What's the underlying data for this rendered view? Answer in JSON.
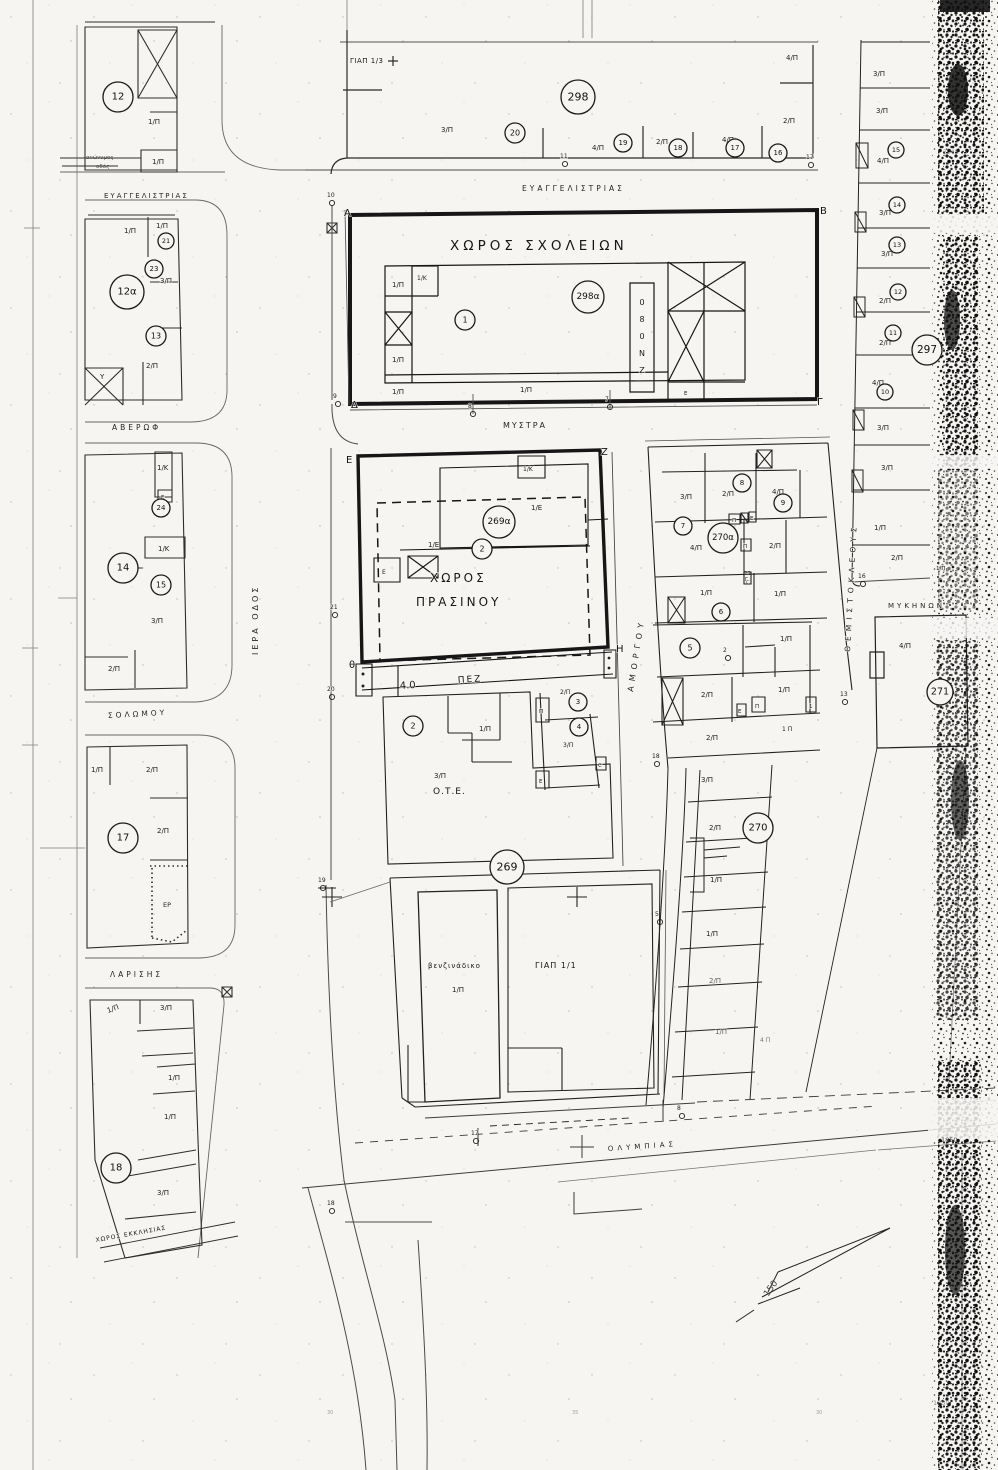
{
  "map": {
    "street_labels": [
      {
        "t": "ΕΥΑΓΓΕΛΙΣΤΡΙΑΣ",
        "x": 104,
        "y": 198,
        "s": 7,
        "ls": 2
      },
      {
        "t": "ΕΥΑΓΓΕΛΙΣΤΡΙΑΣ",
        "x": 522,
        "y": 191,
        "s": 7.5,
        "ls": 3
      },
      {
        "t": "ΑΒΕΡΩΦ",
        "x": 112,
        "y": 430,
        "s": 7.5,
        "ls": 3
      },
      {
        "t": "ΜΥΣΤΡΑ",
        "x": 503,
        "y": 428,
        "s": 8,
        "ls": 2
      },
      {
        "t": "ΣΟΛΩΜΟΥ",
        "x": 108,
        "y": 718,
        "s": 7.5,
        "ls": 3,
        "r": -3
      },
      {
        "t": "ΛΑΡΙΣΗΣ",
        "x": 110,
        "y": 977,
        "s": 7.5,
        "ls": 3
      },
      {
        "t": "ΙΕΡΑ ΟΔΟΣ",
        "x": 258,
        "y": 655,
        "s": 8,
        "ls": 3,
        "r": -90
      },
      {
        "t": "ΑΜΟΡΓΟΥ",
        "x": 633,
        "y": 692,
        "s": 8,
        "ls": 5,
        "r": -81
      },
      {
        "t": "ΘΕΜΙΣΤΟΚΛΕΟΥΣ",
        "x": 850,
        "y": 652,
        "s": 7.5,
        "ls": 5,
        "r": -87
      },
      {
        "t": "ΜΥΚΗΝΩΝ",
        "x": 888,
        "y": 608,
        "s": 7,
        "ls": 3
      },
      {
        "t": "ΟΛΥΜΠΙΑΣ",
        "x": 608,
        "y": 1151,
        "s": 7,
        "ls": 4,
        "r": -4
      }
    ],
    "area_labels": [
      {
        "t": "ΧΩΡΟΣ  ΣΧΟΛΕΙΩΝ",
        "x": 450,
        "y": 250,
        "s": 13.5,
        "ls": 4
      },
      {
        "t": "ΧΩΡΟΣ",
        "x": 430,
        "y": 582,
        "s": 12,
        "ls": 3
      },
      {
        "t": "ΠΡΑΣΙΝΟΥ",
        "x": 416,
        "y": 606,
        "s": 12,
        "ls": 3
      },
      {
        "t": "ΠΕΖ",
        "x": 458,
        "y": 683,
        "s": 9,
        "ls": 2,
        "r": -4
      },
      {
        "t": "Ο.Τ.Ε.",
        "x": 433,
        "y": 794,
        "s": 9,
        "ls": 1
      },
      {
        "t": "βενζινάδικο",
        "x": 428,
        "y": 968,
        "s": 7,
        "ls": 1
      },
      {
        "t": "ΓΙΑΠ 1/1",
        "x": 535,
        "y": 968,
        "s": 8,
        "ls": 1
      },
      {
        "t": "ΓΙΑΠ 1/3",
        "x": 350,
        "y": 63,
        "s": 7,
        "ls": 0.5
      },
      {
        "t": "ΧΩΡΟΣ ΕΚΚΛΗΣΙΑΣ",
        "x": 96,
        "y": 1242,
        "s": 6,
        "ls": 1,
        "r": -10
      }
    ],
    "circled": [
      {
        "n": "12",
        "x": 118,
        "y": 97,
        "r": 15,
        "fs": 10
      },
      {
        "n": "298",
        "x": 578,
        "y": 97,
        "r": 17,
        "fs": 11
      },
      {
        "n": "20",
        "x": 515,
        "y": 133,
        "r": 10,
        "fs": 8
      },
      {
        "n": "19",
        "x": 623,
        "y": 143,
        "r": 9,
        "fs": 7
      },
      {
        "n": "18",
        "x": 678,
        "y": 148,
        "r": 9,
        "fs": 7
      },
      {
        "n": "17",
        "x": 735,
        "y": 148,
        "r": 9,
        "fs": 7
      },
      {
        "n": "16",
        "x": 778,
        "y": 153,
        "r": 9,
        "fs": 7
      },
      {
        "n": "12α",
        "x": 127,
        "y": 292,
        "r": 17,
        "fs": 10
      },
      {
        "n": "21",
        "x": 166,
        "y": 241,
        "r": 8,
        "fs": 6.5
      },
      {
        "n": "23",
        "x": 154,
        "y": 269,
        "r": 9,
        "fs": 7
      },
      {
        "n": "13",
        "x": 156,
        "y": 336,
        "r": 10,
        "fs": 8
      },
      {
        "n": "24",
        "x": 161,
        "y": 508,
        "r": 9,
        "fs": 7
      },
      {
        "n": "14",
        "x": 123,
        "y": 568,
        "r": 15,
        "fs": 10
      },
      {
        "n": "15",
        "x": 161,
        "y": 585,
        "r": 10,
        "fs": 8
      },
      {
        "n": "17",
        "x": 123,
        "y": 838,
        "r": 15,
        "fs": 10
      },
      {
        "n": "18",
        "x": 116,
        "y": 1168,
        "r": 15,
        "fs": 10
      },
      {
        "n": "298α",
        "x": 588,
        "y": 297,
        "r": 16,
        "fs": 9
      },
      {
        "n": "1",
        "x": 465,
        "y": 320,
        "r": 10,
        "fs": 8
      },
      {
        "n": "269α",
        "x": 499,
        "y": 522,
        "r": 16,
        "fs": 9
      },
      {
        "n": "2",
        "x": 482,
        "y": 549,
        "r": 10,
        "fs": 8
      },
      {
        "n": "2",
        "x": 413,
        "y": 726,
        "r": 10,
        "fs": 8
      },
      {
        "n": "269",
        "x": 507,
        "y": 867,
        "r": 17,
        "fs": 11
      },
      {
        "n": "3",
        "x": 578,
        "y": 702,
        "r": 9,
        "fs": 7
      },
      {
        "n": "4",
        "x": 579,
        "y": 727,
        "r": 9,
        "fs": 7
      },
      {
        "n": "7",
        "x": 683,
        "y": 526,
        "r": 9,
        "fs": 7
      },
      {
        "n": "8",
        "x": 742,
        "y": 483,
        "r": 9,
        "fs": 7
      },
      {
        "n": "9",
        "x": 783,
        "y": 503,
        "r": 9,
        "fs": 7
      },
      {
        "n": "270α",
        "x": 723,
        "y": 538,
        "r": 15,
        "fs": 8.5
      },
      {
        "n": "6",
        "x": 721,
        "y": 612,
        "r": 9,
        "fs": 7
      },
      {
        "n": "5",
        "x": 690,
        "y": 648,
        "r": 10,
        "fs": 8
      },
      {
        "n": "270",
        "x": 758,
        "y": 828,
        "r": 15,
        "fs": 10
      },
      {
        "n": "271",
        "x": 940,
        "y": 692,
        "r": 13,
        "fs": 9.5
      },
      {
        "n": "297",
        "x": 927,
        "y": 350,
        "r": 15,
        "fs": 10.5
      },
      {
        "n": "15",
        "x": 896,
        "y": 150,
        "r": 8,
        "fs": 6.5
      },
      {
        "n": "14",
        "x": 897,
        "y": 205,
        "r": 8,
        "fs": 6.5
      },
      {
        "n": "13",
        "x": 897,
        "y": 245,
        "r": 8,
        "fs": 6.5
      },
      {
        "n": "12",
        "x": 898,
        "y": 292,
        "r": 8,
        "fs": 6.5
      },
      {
        "n": "11",
        "x": 893,
        "y": 333,
        "r": 8,
        "fs": 6.5
      },
      {
        "n": "10",
        "x": 885,
        "y": 392,
        "r": 8,
        "fs": 6.5
      }
    ],
    "small_labels": [
      {
        "t": "1/Π",
        "x": 148,
        "y": 124
      },
      {
        "t": "1/Π",
        "x": 152,
        "y": 164
      },
      {
        "t": "1/Π",
        "x": 124,
        "y": 233
      },
      {
        "t": "1/Π",
        "x": 156,
        "y": 228
      },
      {
        "t": "3/Π",
        "x": 160,
        "y": 283
      },
      {
        "t": "2/Π",
        "x": 146,
        "y": 368
      },
      {
        "t": "Υ",
        "x": 100,
        "y": 379
      },
      {
        "t": "1/Κ",
        "x": 157,
        "y": 470
      },
      {
        "t": "Ε",
        "x": 161,
        "y": 499,
        "s": 5.5
      },
      {
        "t": "1/Κ",
        "x": 158,
        "y": 551
      },
      {
        "t": "3/Π",
        "x": 151,
        "y": 623
      },
      {
        "t": "2/Π",
        "x": 108,
        "y": 671
      },
      {
        "t": "1/Π",
        "x": 91,
        "y": 772
      },
      {
        "t": "2/Π",
        "x": 146,
        "y": 772
      },
      {
        "t": "2/Π",
        "x": 157,
        "y": 833
      },
      {
        "t": "ΕΡ",
        "x": 163,
        "y": 907,
        "s": 6.5
      },
      {
        "t": "1/Π",
        "x": 108,
        "y": 1013,
        "r": -20
      },
      {
        "t": "3/Π",
        "x": 160,
        "y": 1010
      },
      {
        "t": "1/Π",
        "x": 168,
        "y": 1080
      },
      {
        "t": "1/Π",
        "x": 164,
        "y": 1119
      },
      {
        "t": "3/Π",
        "x": 157,
        "y": 1195
      },
      {
        "t": "3/Π",
        "x": 441,
        "y": 132
      },
      {
        "t": "4/Π",
        "x": 592,
        "y": 150
      },
      {
        "t": "2/Π",
        "x": 656,
        "y": 144
      },
      {
        "t": "4/Π",
        "x": 722,
        "y": 142
      },
      {
        "t": "2/Π",
        "x": 783,
        "y": 123
      },
      {
        "t": "4/Π",
        "x": 786,
        "y": 60
      },
      {
        "t": "1/Π",
        "x": 392,
        "y": 287
      },
      {
        "t": "1/Κ",
        "x": 417,
        "y": 280,
        "s": 6
      },
      {
        "t": "1/Π",
        "x": 392,
        "y": 362
      },
      {
        "t": "1/Π",
        "x": 392,
        "y": 394
      },
      {
        "t": "1/Π",
        "x": 520,
        "y": 392
      },
      {
        "t": "Ε",
        "x": 684,
        "y": 395,
        "s": 5.5
      },
      {
        "t": "1/Κ",
        "x": 523,
        "y": 471,
        "s": 6
      },
      {
        "t": "1/Ε",
        "x": 531,
        "y": 510
      },
      {
        "t": "1/Ε",
        "x": 428,
        "y": 547
      },
      {
        "t": "Ε",
        "x": 382,
        "y": 574,
        "s": 6
      },
      {
        "t": "4.0",
        "x": 400,
        "y": 689,
        "s": 10,
        "r": -4
      },
      {
        "t": "1/Π",
        "x": 479,
        "y": 731
      },
      {
        "t": "3/Π",
        "x": 434,
        "y": 778
      },
      {
        "t": "2/Π",
        "x": 560,
        "y": 694,
        "s": 6
      },
      {
        "t": "Π",
        "x": 539,
        "y": 713,
        "s": 5.5
      },
      {
        "t": "3/Π",
        "x": 563,
        "y": 747,
        "s": 6
      },
      {
        "t": "Ε",
        "x": 539,
        "y": 783,
        "s": 5.5
      },
      {
        "t": "C",
        "x": 598,
        "y": 767,
        "s": 5.5
      },
      {
        "t": "3/Π",
        "x": 680,
        "y": 499
      },
      {
        "t": "2/Π",
        "x": 722,
        "y": 496
      },
      {
        "t": "4/Π",
        "x": 772,
        "y": 494
      },
      {
        "t": "4/Π",
        "x": 690,
        "y": 550
      },
      {
        "t": "2/Π",
        "x": 769,
        "y": 548
      },
      {
        "t": "Π",
        "x": 732,
        "y": 522,
        "s": 5.5
      },
      {
        "t": "Ε",
        "x": 750,
        "y": 520,
        "s": 5.5
      },
      {
        "t": "Π",
        "x": 743,
        "y": 548,
        "s": 5.5
      },
      {
        "t": "1/Π",
        "x": 700,
        "y": 595
      },
      {
        "t": "1/Π",
        "x": 774,
        "y": 596
      },
      {
        "t": "Γ",
        "x": 745,
        "y": 581,
        "s": 5
      },
      {
        "t": "1/Π",
        "x": 780,
        "y": 641
      },
      {
        "t": "2/Π",
        "x": 701,
        "y": 697
      },
      {
        "t": "1/Π",
        "x": 778,
        "y": 692
      },
      {
        "t": "Ε",
        "x": 738,
        "y": 713,
        "s": 5.5
      },
      {
        "t": "Π",
        "x": 755,
        "y": 708,
        "s": 5.5
      },
      {
        "t": "1",
        "x": 809,
        "y": 708,
        "s": 5.5
      },
      {
        "t": "2/Π",
        "x": 706,
        "y": 740
      },
      {
        "t": "1 Π",
        "x": 782,
        "y": 731,
        "s": 6
      },
      {
        "t": "3/Π",
        "x": 701,
        "y": 782
      },
      {
        "t": "3/Π",
        "x": 703,
        "y": 786,
        "o": 0
      },
      {
        "t": "2/Π",
        "x": 709,
        "y": 830
      },
      {
        "t": "1/Π",
        "x": 710,
        "y": 882
      },
      {
        "t": "1/Π",
        "x": 706,
        "y": 936
      },
      {
        "t": "2/Π",
        "x": 709,
        "y": 983,
        "o": 0.7
      },
      {
        "t": "1/Π",
        "x": 715,
        "y": 1034,
        "o": 0.7
      },
      {
        "t": "4 Π",
        "x": 760,
        "y": 1042,
        "o": 0.6,
        "s": 6
      },
      {
        "t": "3/Π",
        "x": 873,
        "y": 76
      },
      {
        "t": "3/Π",
        "x": 876,
        "y": 113
      },
      {
        "t": "4/Π",
        "x": 877,
        "y": 163
      },
      {
        "t": "3/Π",
        "x": 879,
        "y": 215
      },
      {
        "t": "3/Π",
        "x": 881,
        "y": 256
      },
      {
        "t": "2/Π",
        "x": 879,
        "y": 303
      },
      {
        "t": "2/Π",
        "x": 879,
        "y": 345
      },
      {
        "t": "4/Π",
        "x": 872,
        "y": 385
      },
      {
        "t": "3/Π",
        "x": 877,
        "y": 430
      },
      {
        "t": "3/Π",
        "x": 881,
        "y": 470
      },
      {
        "t": "1/Π",
        "x": 874,
        "y": 530
      },
      {
        "t": "2/Π",
        "x": 891,
        "y": 560
      },
      {
        "t": "1/Π",
        "x": 936,
        "y": 570,
        "s": 5.5
      },
      {
        "t": "4/Π",
        "x": 899,
        "y": 648
      },
      {
        "t": "1/Π",
        "x": 452,
        "y": 992
      }
    ],
    "points": [
      {
        "t": "10",
        "x": 327,
        "y": 197
      },
      {
        "t": "11",
        "x": 560,
        "y": 158
      },
      {
        "t": "17",
        "x": 806,
        "y": 159
      },
      {
        "t": "9",
        "x": 333,
        "y": 398
      },
      {
        "t": "8",
        "x": 468,
        "y": 408
      },
      {
        "t": "7",
        "x": 605,
        "y": 401
      },
      {
        "t": "21",
        "x": 330,
        "y": 609
      },
      {
        "t": "20",
        "x": 327,
        "y": 691
      },
      {
        "t": "19",
        "x": 318,
        "y": 882
      },
      {
        "t": "18",
        "x": 327,
        "y": 1205
      },
      {
        "t": "17",
        "x": 471,
        "y": 1135
      },
      {
        "t": "8",
        "x": 677,
        "y": 1110
      },
      {
        "t": "16",
        "x": 858,
        "y": 578
      },
      {
        "t": "13",
        "x": 840,
        "y": 696
      },
      {
        "t": "5",
        "x": 655,
        "y": 916
      },
      {
        "t": "2",
        "x": 723,
        "y": 652
      },
      {
        "t": "18",
        "x": 652,
        "y": 758
      }
    ],
    "corners": [
      {
        "t": "Α",
        "x": 344,
        "y": 216
      },
      {
        "t": "Β",
        "x": 820,
        "y": 214
      },
      {
        "t": "Δ",
        "x": 351,
        "y": 408
      },
      {
        "t": "Γ",
        "x": 817,
        "y": 405
      },
      {
        "t": "Ε",
        "x": 346,
        "y": 463
      },
      {
        "t": "Ζ",
        "x": 601,
        "y": 455
      },
      {
        "t": "θ",
        "x": 349,
        "y": 668
      },
      {
        "t": "Η",
        "x": 616,
        "y": 652
      }
    ],
    "vertical_letters": {
      "letters": [
        "0",
        "8",
        "0",
        "Ν",
        "Ζ"
      ],
      "x": 642,
      "y": 305,
      "dy": 17
    },
    "notes": [
      {
        "t": "ανώνυμος",
        "x": 86,
        "y": 159,
        "s": 5.5
      },
      {
        "t": "οδός",
        "x": 96,
        "y": 168,
        "s": 5.5
      },
      {
        "t": "22",
        "x": 744,
        "y": 575,
        "s": 5.5
      },
      {
        "t": "C",
        "x": 746,
        "y": 584,
        "s": 5.5
      },
      {
        "t": "2040",
        "x": 943,
        "y": 154,
        "s": 6,
        "o": 0.55
      },
      {
        "t": "1850",
        "x": 941,
        "y": 1142,
        "s": 6.5
      },
      {
        "t": "1850",
        "x": 933,
        "y": 1405,
        "s": 6.5,
        "o": 0.6
      },
      {
        "t": "150",
        "x": 768,
        "y": 1297,
        "s": 9,
        "r": -55
      },
      {
        "t": "30",
        "x": 327,
        "y": 1414,
        "s": 5,
        "o": 0.5
      },
      {
        "t": "35",
        "x": 572,
        "y": 1414,
        "s": 5,
        "o": 0.5
      },
      {
        "t": "30",
        "x": 816,
        "y": 1414,
        "s": 5,
        "o": 0.5
      }
    ]
  }
}
